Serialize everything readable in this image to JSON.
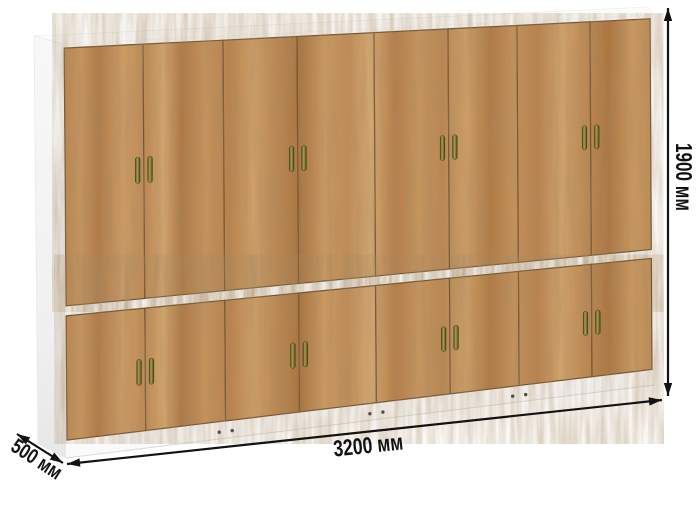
{
  "dimensions": {
    "width_label": "3200 мм",
    "height_label": "1900 мм",
    "depth_label": "500 мм"
  },
  "furniture": {
    "name": "wardrobe",
    "upper_doors": 8,
    "lower_doors": 8,
    "handle_pairs_per_row": 4,
    "colors": {
      "wood_base": "#c4905a",
      "wood_light": "#d8ab77",
      "wood_dark": "#a06c3c",
      "seam": "#6b4a28",
      "carcass": "#fafafa",
      "handle_brass": "#8a8140",
      "foot_dot": "#4f4f4f",
      "annotation": "#121212"
    }
  }
}
